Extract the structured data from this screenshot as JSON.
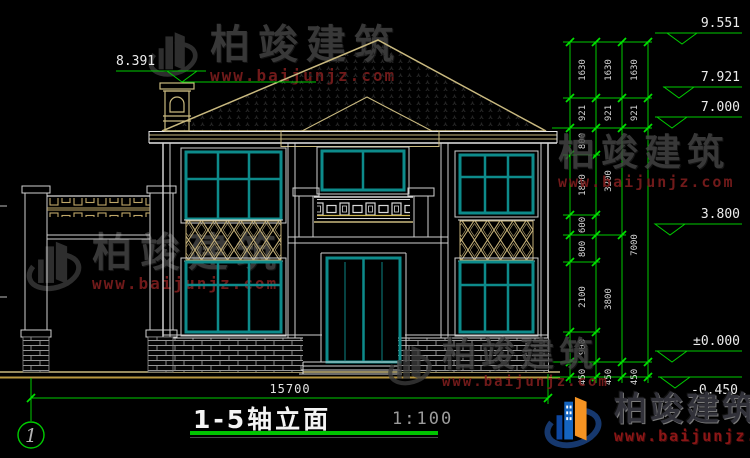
{
  "watermark": {
    "brand": "柏竣建筑",
    "url": "www.baijunjz.com"
  },
  "title_block": {
    "drawing_title": "1-5轴立面",
    "scale": "1:100",
    "axis_number": "1"
  },
  "overall_dimension": "15700",
  "elevation_markers": {
    "roof_ridge": "9.551",
    "chimney_left": "8.391",
    "roof_upper": "7.921",
    "eave": "7.000",
    "window_head": "3.800",
    "ground_floor": "±0.000",
    "site_ground": "-0.450"
  },
  "dimension_chains": {
    "inner": [
      "1630",
      "921",
      "800",
      "1800",
      "600",
      "800",
      "2100",
      "900",
      "450"
    ],
    "middle": [
      "1630",
      "921",
      "3200",
      "3800",
      "450"
    ],
    "outer": [
      "1630",
      "921",
      "7000",
      "450"
    ]
  }
}
